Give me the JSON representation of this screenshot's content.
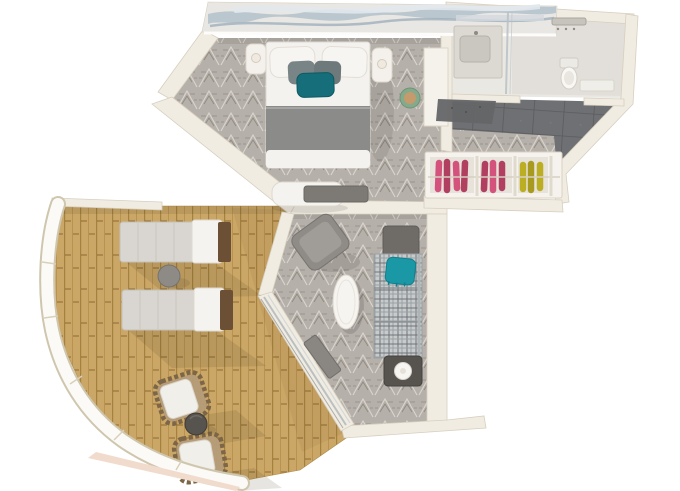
{
  "scene": {
    "kind": "3d-floorplan-render",
    "description": "Top-down 3D rendering of a suite with bedroom, bathroom, dressing area, living room and large wrap wooden balcony",
    "background": "#ffffff"
  },
  "rooms": [
    "bedroom",
    "bathroom",
    "dressing-area",
    "living-room",
    "balcony"
  ],
  "furniture": [
    "wall-art",
    "king-bed",
    "bed-pillows",
    "teal-accent-pillow",
    "nightstand-left",
    "nightstand-right",
    "foot-bench",
    "tv-console",
    "vanity-desk",
    "stool",
    "bath-mat",
    "bathroom-vanity-sink",
    "shower-enclosure",
    "toilet",
    "bathroom-bench",
    "wardrobe-unit",
    "hanging-clothes-pink",
    "hanging-clothes-yellow",
    "sofa",
    "sofa-teal-throw",
    "coffee-table",
    "armchair",
    "side-table-with-lamp",
    "door-console",
    "sliding-glass-door",
    "sun-lounger-top",
    "sun-lounger-bottom",
    "deck-round-table",
    "patio-chair-top",
    "patio-chair-bottom",
    "patio-round-table",
    "balcony-railing",
    "wood-deck"
  ],
  "palette": {
    "bg": "#ffffff",
    "wall": "#f1ece2",
    "wall_edge": "#d7cfbf",
    "carpet_base": "#b6b0aa",
    "carpet_light": "#dad5cf",
    "carpet_dark": "#90897f",
    "deck_base": "#caa767",
    "deck_line": "#a5803f",
    "tile_base": "#6f7073",
    "tile_line": "#595b5d",
    "bath_floor": "#eae8e3",
    "linen_white": "#f4f2ee",
    "blanket_gray": "#8b8b89",
    "pillow_gray": "#798486",
    "pillow_teal": "#156e79",
    "plaid_base": "#c8cbcc",
    "plaid_line": "#70757a",
    "sofa_end_dark": "#6f6c68",
    "throw_teal": "#1a98a6",
    "armchair": "#8f8c88",
    "console_gray": "#7d7a76",
    "clothes_pink": "#d4537c",
    "clothes_pink_dark": "#b03f60",
    "clothes_yellow": "#bcae22",
    "clothes_yellow_dark": "#a89a1e",
    "stool_green": "#85a98b",
    "stool_top": "#c59a6d",
    "railing": "#fbfaf6",
    "railing_edge": "#cfc6ae",
    "art_base": "#e9e7e3",
    "art_wave": "#b6c3cc",
    "art_wave_line": "#9fb0bc",
    "art_wave_light": "#e2e8ec",
    "table_white": "#f6f4f0",
    "side_table_dark": "#57534e",
    "lounger_pad": "#d9d6d1",
    "lounger_white": "#f5f3ef",
    "lounger_brown": "#6b5036",
    "wicker": "#b59c78",
    "wicker_dark": "#7c6647",
    "mat_dark": "#646567",
    "deck_fascia": "#f0dbcc"
  }
}
